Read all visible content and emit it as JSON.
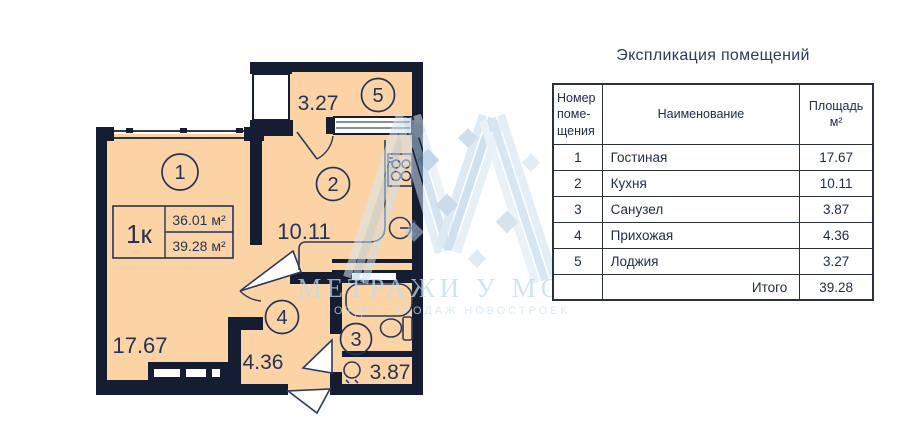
{
  "plan": {
    "type_label": "1к",
    "area_1": "36.01 м²",
    "area_2": "39.28 м²",
    "rooms": [
      {
        "num": "1",
        "area": "17.67"
      },
      {
        "num": "2",
        "area": "10.11"
      },
      {
        "num": "3",
        "area": "3.87"
      },
      {
        "num": "4",
        "area": "4.36"
      },
      {
        "num": "5",
        "area": "3.27"
      }
    ]
  },
  "watermark": {
    "title": "МЕТРАЖИ У МОРЯ",
    "subtitle": "ОТДЕЛ ПРОДАЖ НОВОСТРОЕК"
  },
  "table": {
    "title": "Экспликация помещений",
    "columns": [
      "Номер поме-щения",
      "Наименование",
      "Площадь м²"
    ],
    "rows": [
      {
        "num": "1",
        "name": "Гостиная",
        "area": "17.67"
      },
      {
        "num": "2",
        "name": "Кухня",
        "area": "10.11"
      },
      {
        "num": "3",
        "name": "Санузел",
        "area": "3.87"
      },
      {
        "num": "4",
        "name": "Прихожая",
        "area": "4.36"
      },
      {
        "num": "5",
        "name": "Лоджия",
        "area": "3.27"
      }
    ],
    "total_label": "Итого",
    "total_value": "39.28"
  },
  "colors": {
    "wall": "#151d33",
    "floor": "#fcd3a5",
    "line": "#253357",
    "watermark_blue": "#b7d2e8"
  }
}
